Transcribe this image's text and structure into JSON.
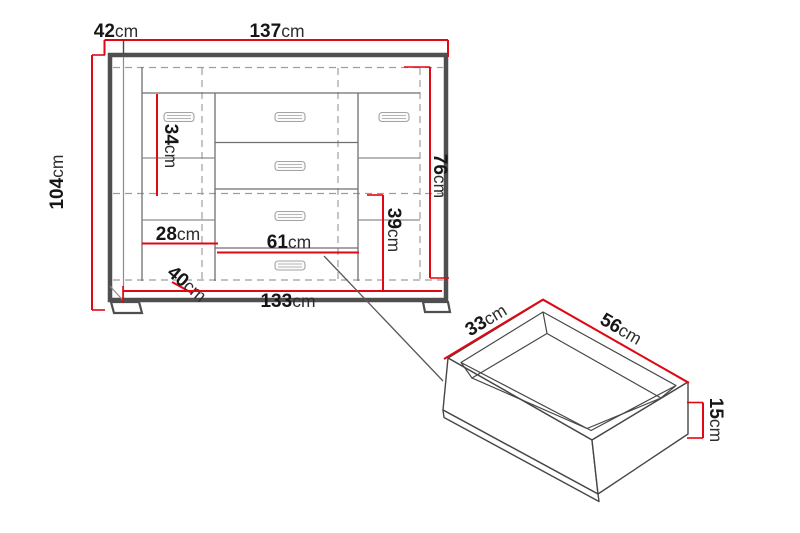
{
  "cabinet_front": {
    "dimensions": {
      "depth_top": {
        "value": "42",
        "unit": "cm"
      },
      "width_top": {
        "value": "137",
        "unit": "cm"
      },
      "height_left": {
        "value": "104",
        "unit": "cm"
      },
      "inner_height_34": {
        "value": "34",
        "unit": "cm"
      },
      "shelf_width_28": {
        "value": "28",
        "unit": "cm"
      },
      "drawer_width_61": {
        "value": "61",
        "unit": "cm"
      },
      "inner_height_76": {
        "value": "76",
        "unit": "cm"
      },
      "inner_height_39": {
        "value": "39",
        "unit": "cm"
      },
      "inner_depth_40": {
        "value": "40",
        "unit": "cm"
      },
      "width_bottom": {
        "value": "133",
        "unit": "cm"
      }
    }
  },
  "drawer_detail": {
    "dimensions": {
      "depth_33": {
        "value": "33",
        "unit": "cm"
      },
      "width_56": {
        "value": "56",
        "unit": "cm"
      },
      "height_15": {
        "value": "15",
        "unit": "cm"
      }
    }
  },
  "colors": {
    "dimension": "#e30613",
    "outline": "#4f4f4f",
    "line": "#8c8c8c",
    "dashed": "#9e9e9e",
    "text": "#161616"
  }
}
